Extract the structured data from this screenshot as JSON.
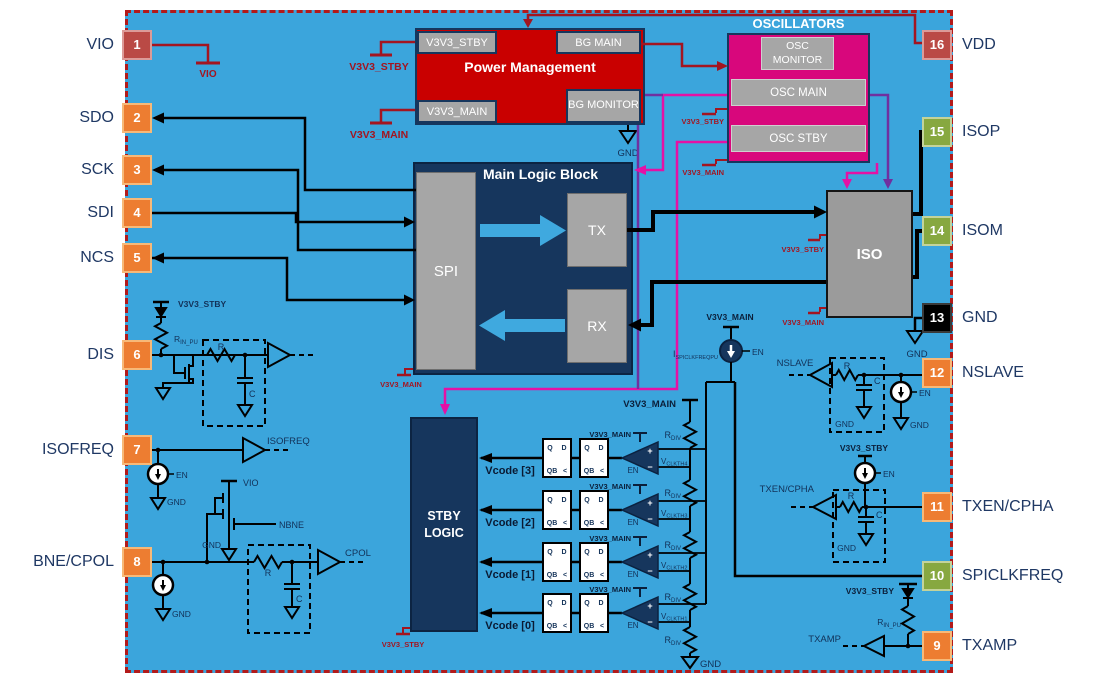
{
  "pins": {
    "left": [
      {
        "num": "1",
        "label": "VIO"
      },
      {
        "num": "2",
        "label": "SDO"
      },
      {
        "num": "3",
        "label": "SCK"
      },
      {
        "num": "4",
        "label": "SDI"
      },
      {
        "num": "5",
        "label": "NCS"
      },
      {
        "num": "6",
        "label": "DIS"
      },
      {
        "num": "7",
        "label": "ISOFREQ"
      },
      {
        "num": "8",
        "label": "BNE/CPOL"
      }
    ],
    "right": [
      {
        "num": "16",
        "label": "VDD"
      },
      {
        "num": "15",
        "label": "ISOP"
      },
      {
        "num": "14",
        "label": "ISOM"
      },
      {
        "num": "13",
        "label": "GND"
      },
      {
        "num": "12",
        "label": "NSLAVE"
      },
      {
        "num": "11",
        "label": "TXEN/CPHA"
      },
      {
        "num": "10",
        "label": "SPICLKFREQ"
      },
      {
        "num": "9",
        "label": "TXAMP"
      }
    ]
  },
  "blocks": {
    "power": {
      "title": "Power Management",
      "v3v3_stby": "V3V3_STBY",
      "bg_main": "BG MAIN",
      "v3v3_main": "V3V3_MAIN",
      "bg_monitor": "BG MONITOR"
    },
    "oscillators": {
      "title": "OSCILLATORS",
      "monitor": "OSC MONITOR",
      "main": "OSC MAIN",
      "stby": "OSC STBY"
    },
    "main_logic": {
      "title": "Main Logic Block",
      "spi": "SPI",
      "tx": "TX",
      "rx": "RX"
    },
    "iso": {
      "label": "ISO"
    },
    "stby_logic": {
      "label": "STBY LOGIC"
    }
  },
  "rails": {
    "v3v3_stby": "V3V3_STBY",
    "v3v3_main": "V3V3_MAIN",
    "vio": "VIO",
    "gnd": "GND"
  },
  "labels": {
    "en": "EN",
    "gnd": "GND",
    "r": "R",
    "c": "C",
    "nbne": "NBNE",
    "isofreq": "ISOFREQ",
    "cpol": "CPOL",
    "txamp": "TXAMP",
    "txen_cpha": "TXEN/CPHA",
    "nslave": "NSLAVE",
    "r_base": "R",
    "rin_pu_sub": "IN_PU",
    "rdiv_sub": "DIV",
    "i_base": "I",
    "ispiclkfreqpu_sub": "SPICLKFREQPU",
    "v_base": "V",
    "vclkth_subs": [
      "CLKTH4",
      "CLKTH3",
      "CLKTH2",
      "CLKTH1"
    ],
    "vcode": [
      "Vcode [3]",
      "Vcode [2]",
      "Vcode [1]",
      "Vcode [0]"
    ],
    "ff": {
      "q": "Q",
      "d": "D",
      "qb": "QB",
      "clk": "<"
    }
  },
  "colors": {
    "background_blue": "#3BA5DC",
    "dashed_border_red": "#B31A1A",
    "power_red": "#C90000",
    "oscillator_magenta": "#D8077C",
    "navy_block": "#16365D",
    "gray_block": "#A6A6A6",
    "pin_orange": "#ED7D31",
    "pin_green": "#87A840",
    "pin_dark_red": "#BA4A45",
    "pin_black": "#000000",
    "wire_black": "#000000",
    "wire_dark_red": "#A31520",
    "wire_magenta": "#E511A5",
    "wire_purple": "#7030A0",
    "label_navy": "#1F3864"
  }
}
